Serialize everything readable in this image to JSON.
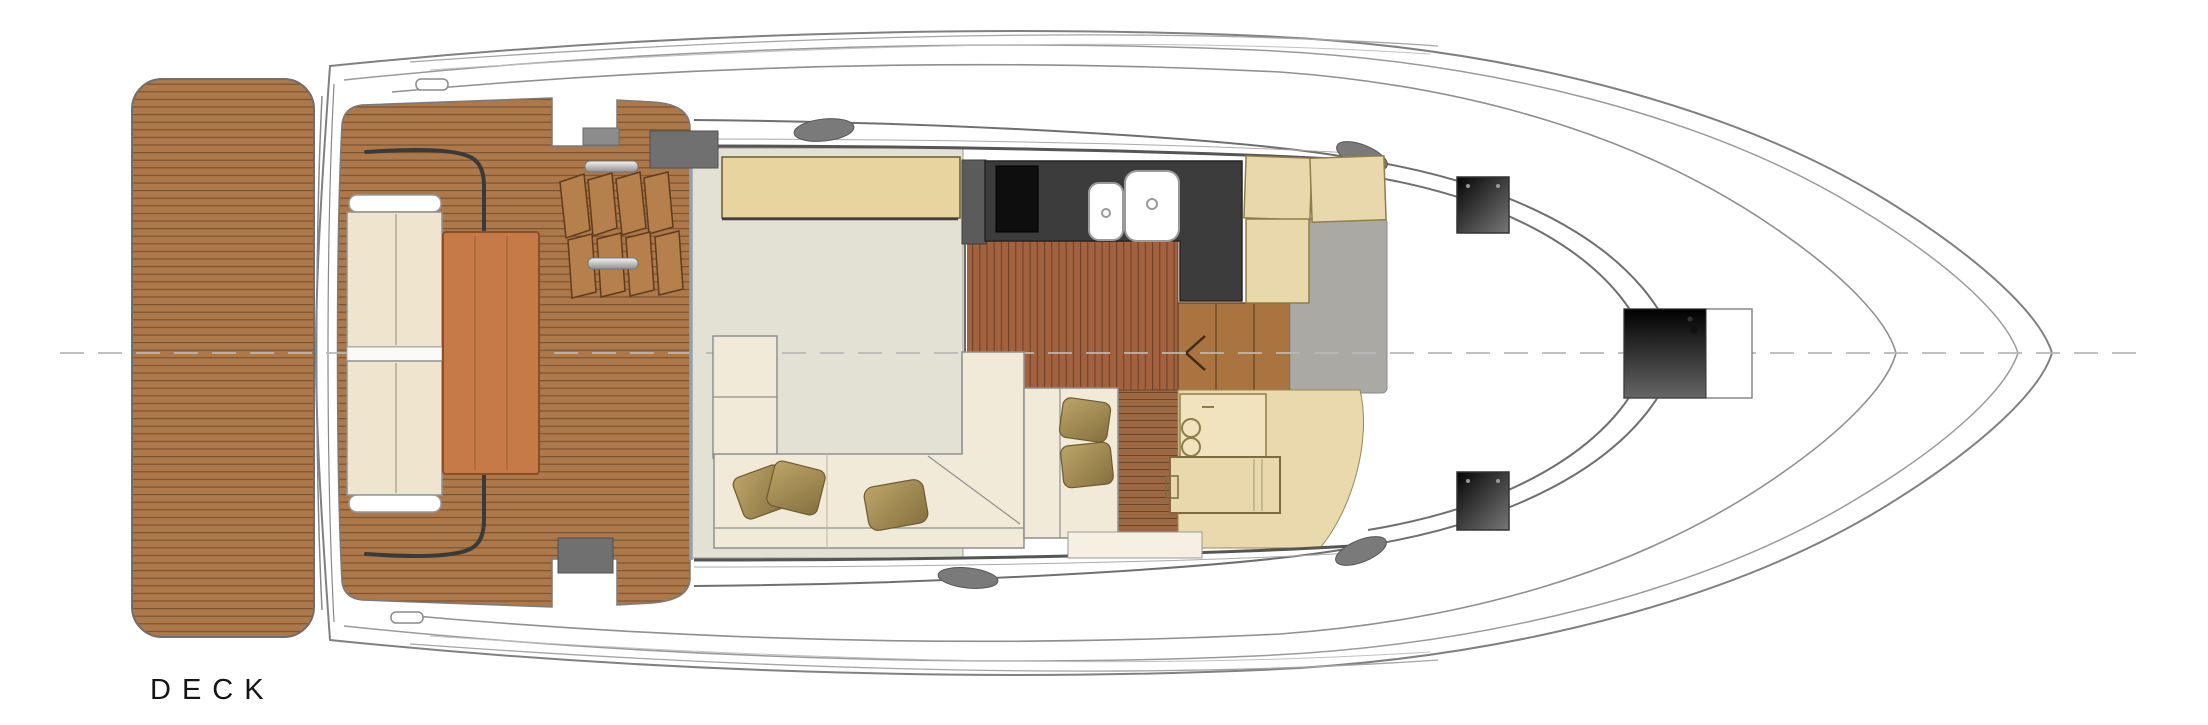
{
  "label": {
    "text": "DECK"
  },
  "plan": {
    "type": "yacht-main-deck-floor-plan",
    "areas": [
      "swim-platform",
      "transom",
      "cockpit-teak-floor",
      "cockpit-bench-seat",
      "cockpit-table",
      "stacked-folding-chairs",
      "cockpit-grab-rails",
      "side-boarding-gates",
      "salon-carpet",
      "salon-sideboard",
      "salon-l-shaped-sofa",
      "sofa-pillows",
      "galley-counter",
      "galley-cooktop",
      "galley-double-sink",
      "galley-wood-floor",
      "companionway-stairs",
      "stairs-down-arrow",
      "helm-seat-cushions",
      "helm-floor-rug",
      "dinette-seat",
      "dinette-pillows",
      "wet-bar-double-basin",
      "dinette-table",
      "windshield",
      "side-walkways",
      "foredeck-hatch-aft-port",
      "foredeck-hatch-aft-starboard",
      "anchor-windlass-locker",
      "bow",
      "hull-centerline"
    ],
    "colors": {
      "teak": "#AD794B",
      "teak_line": "#7C5330",
      "galley_floor": "#A2613F",
      "carpet": "#E3E1D4",
      "sofa": "#F1EAD8",
      "bench_cushion": "#EFE5CE",
      "pillow": "#A98F55",
      "sideboard": "#E7D49E",
      "counter": "#3C3C3C",
      "cooktop": "#0E0E0E",
      "sink": "#FFFFFF",
      "cockpit_table": "#C57A48",
      "tan_furniture": "#E9D8AB",
      "rug": "#ABA9A4",
      "stairs": "#A9743F",
      "hatch_dark": "#1A1A1A",
      "hull_outline": "#808080"
    }
  }
}
